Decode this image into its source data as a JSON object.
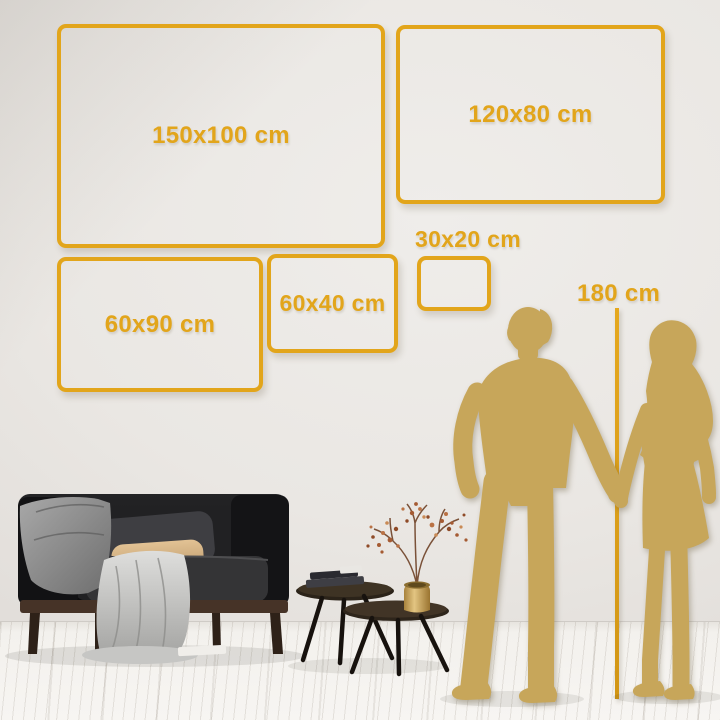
{
  "title": "Wall art size comparison infographic",
  "frames": [
    {
      "label": "150x100 cm"
    },
    {
      "label": "120x80 cm"
    },
    {
      "label": "60x90 cm"
    },
    {
      "label": "60x40 cm"
    },
    {
      "label": "30x20 cm"
    }
  ],
  "ruler": {
    "label": "180 cm"
  },
  "colors": {
    "accent": "#E2A51B",
    "silhouette": "#C7A65A",
    "wall": "#E8E5E1",
    "floor": "#F5F3EF"
  }
}
